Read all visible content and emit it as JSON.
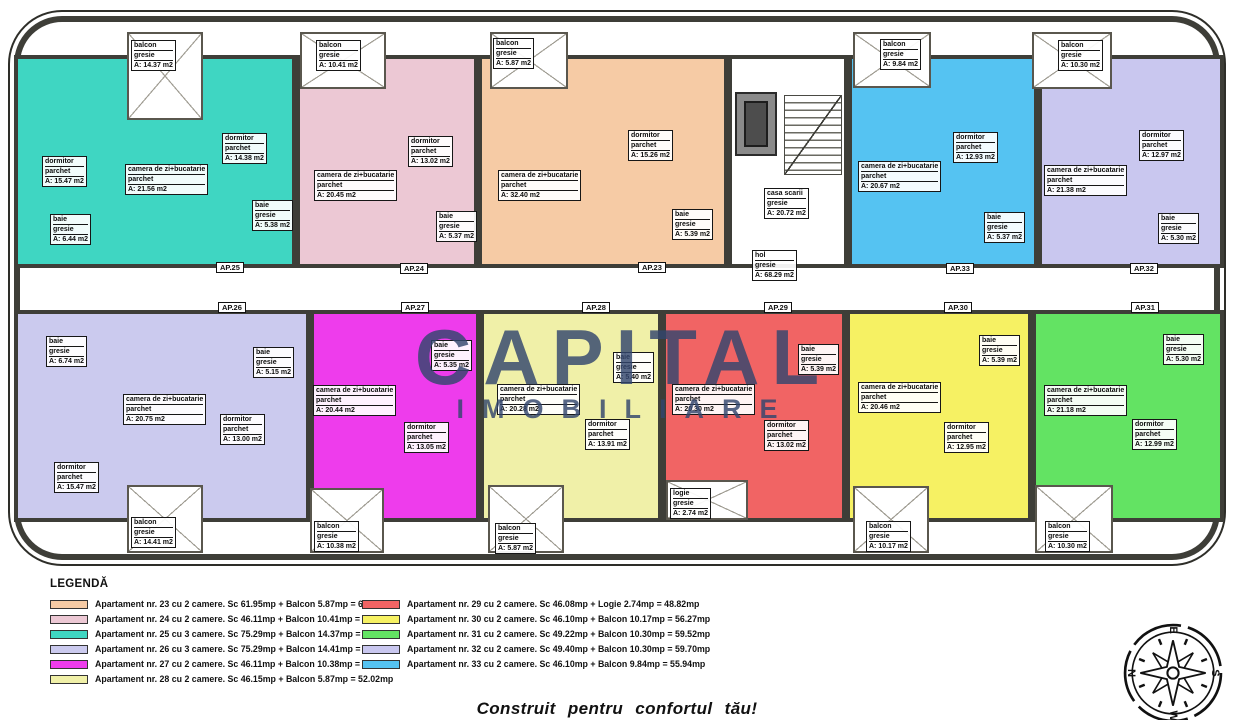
{
  "colors": {
    "ap23": "#f6cba5",
    "ap24": "#ecc8d4",
    "ap25": "#3fd6c2",
    "ap26": "#cbcaee",
    "ap27": "#ee3cec",
    "ap28": "#f0f0a8",
    "ap29": "#f16464",
    "ap30": "#f6f163",
    "ap31": "#63e363",
    "ap32": "#c9c7ef",
    "ap33": "#55c3f2",
    "wall": "#3e3e38",
    "watermark": "#33466e"
  },
  "watermark": {
    "line1": "CAPITAL",
    "line2": "IMOBILIARE"
  },
  "slogan": "Construit pentru confortul tău!",
  "compass": {
    "top": "E",
    "left": "N",
    "right": "S",
    "bottom": "W"
  },
  "core": {
    "casa_scarii": {
      "name": "casa scarii",
      "floor": "gresie",
      "area": "A: 20.72 m2"
    },
    "hol": {
      "name": "hol",
      "floor": "gresie",
      "area": "A: 68.29 m2"
    }
  },
  "apartments": [
    {
      "tag": "AP.25",
      "balcony": {
        "name": "balcon",
        "floor": "gresie",
        "area": "A: 14.37 m2"
      },
      "rooms": [
        {
          "name": "dormitor",
          "floor": "parchet",
          "area": "A: 15.47 m2"
        },
        {
          "name": "camera de zi+bucatarie",
          "floor": "parchet",
          "area": "A: 21.56 m2"
        },
        {
          "name": "dormitor",
          "floor": "parchet",
          "area": "A: 14.38 m2"
        },
        {
          "name": "baie",
          "floor": "gresie",
          "area": "A: 6.44 m2"
        },
        {
          "name": "baie",
          "floor": "gresie",
          "area": "A: 5.38 m2"
        }
      ]
    },
    {
      "tag": "AP.24",
      "balcony": {
        "name": "balcon",
        "floor": "gresie",
        "area": "A: 10.41 m2"
      },
      "rooms": [
        {
          "name": "camera de zi+bucatarie",
          "floor": "parchet",
          "area": "A: 20.45 m2"
        },
        {
          "name": "dormitor",
          "floor": "parchet",
          "area": "A: 13.02 m2"
        },
        {
          "name": "baie",
          "floor": "gresie",
          "area": "A: 5.37 m2"
        }
      ]
    },
    {
      "tag": "AP.23",
      "balcony": {
        "name": "balcon",
        "floor": "gresie",
        "area": "A: 5.87 m2"
      },
      "rooms": [
        {
          "name": "camera de zi+bucatarie",
          "floor": "parchet",
          "area": "A: 32.40 m2"
        },
        {
          "name": "dormitor",
          "floor": "parchet",
          "area": "A: 15.26 m2"
        },
        {
          "name": "baie",
          "floor": "gresie",
          "area": "A: 5.39 m2"
        }
      ]
    },
    {
      "tag": "AP.33",
      "balcony": {
        "name": "balcon",
        "floor": "gresie",
        "area": "A: 9.84 m2"
      },
      "rooms": [
        {
          "name": "camera de zi+bucatarie",
          "floor": "parchet",
          "area": "A: 20.67 m2"
        },
        {
          "name": "dormitor",
          "floor": "parchet",
          "area": "A: 12.93 m2"
        },
        {
          "name": "baie",
          "floor": "gresie",
          "area": "A: 5.37 m2"
        }
      ]
    },
    {
      "tag": "AP.32",
      "balcony": {
        "name": "balcon",
        "floor": "gresie",
        "area": "A: 10.30 m2"
      },
      "rooms": [
        {
          "name": "camera de zi+bucatarie",
          "floor": "parchet",
          "area": "A: 21.38 m2"
        },
        {
          "name": "dormitor",
          "floor": "parchet",
          "area": "A: 12.97 m2"
        },
        {
          "name": "baie",
          "floor": "gresie",
          "area": "A: 5.30 m2"
        }
      ]
    },
    {
      "tag": "AP.26",
      "balcony": {
        "name": "balcon",
        "floor": "gresie",
        "area": "A: 14.41 m2"
      },
      "rooms": [
        {
          "name": "baie",
          "floor": "gresie",
          "area": "A: 6.74 m2"
        },
        {
          "name": "camera de zi+bucatarie",
          "floor": "parchet",
          "area": "A: 20.75 m2"
        },
        {
          "name": "baie",
          "floor": "gresie",
          "area": "A: 5.15 m2"
        },
        {
          "name": "dormitor",
          "floor": "parchet",
          "area": "A: 13.00 m2"
        },
        {
          "name": "dormitor",
          "floor": "parchet",
          "area": "A: 15.47 m2"
        }
      ]
    },
    {
      "tag": "AP.27",
      "balcony": {
        "name": "balcon",
        "floor": "gresie",
        "area": "A: 10.38 m2"
      },
      "rooms": [
        {
          "name": "camera de zi+bucatarie",
          "floor": "parchet",
          "area": "A: 20.44 m2"
        },
        {
          "name": "baie",
          "floor": "gresie",
          "area": "A: 5.35 m2"
        },
        {
          "name": "dormitor",
          "floor": "parchet",
          "area": "A: 13.05 m2"
        }
      ]
    },
    {
      "tag": "AP.28",
      "balcony": {
        "name": "balcon",
        "floor": "gresie",
        "area": "A: 5.87 m2"
      },
      "rooms": [
        {
          "name": "camera de zi+bucatarie",
          "floor": "parchet",
          "area": "A: 20.28 m2"
        },
        {
          "name": "baie",
          "floor": "gresie",
          "area": "A: 5.40 m2"
        },
        {
          "name": "dormitor",
          "floor": "parchet",
          "area": "A: 13.91 m2"
        }
      ]
    },
    {
      "tag": "AP.29",
      "balcony": {
        "name": "logie",
        "floor": "gresie",
        "area": "A: 2.74 m2"
      },
      "rooms": [
        {
          "name": "camera de zi+bucatarie",
          "floor": "parchet",
          "area": "A: 20.30 m2"
        },
        {
          "name": "baie",
          "floor": "gresie",
          "area": "A: 5.39 m2"
        },
        {
          "name": "dormitor",
          "floor": "parchet",
          "area": "A: 13.02 m2"
        }
      ]
    },
    {
      "tag": "AP.30",
      "balcony": {
        "name": "balcon",
        "floor": "gresie",
        "area": "A: 10.17 m2"
      },
      "rooms": [
        {
          "name": "camera de zi+bucatarie",
          "floor": "parchet",
          "area": "A: 20.46 m2"
        },
        {
          "name": "baie",
          "floor": "gresie",
          "area": "A: 5.39 m2"
        },
        {
          "name": "dormitor",
          "floor": "parchet",
          "area": "A: 12.95 m2"
        }
      ]
    },
    {
      "tag": "AP.31",
      "balcony": {
        "name": "balcon",
        "floor": "gresie",
        "area": "A: 10.30 m2"
      },
      "rooms": [
        {
          "name": "camera de zi+bucatarie",
          "floor": "parchet",
          "area": "A: 21.18 m2"
        },
        {
          "name": "baie",
          "floor": "gresie",
          "area": "A: 5.30 m2"
        },
        {
          "name": "dormitor",
          "floor": "parchet",
          "area": "A: 12.99 m2"
        }
      ]
    }
  ],
  "legend": {
    "title": "LEGENDĂ",
    "col1": [
      {
        "text": "Apartament nr. 23 cu 2 camere. Sc 61.95mp + Balcon 5.87mp = 67.82mp"
      },
      {
        "text": "Apartament nr. 24 cu 2 camere. Sc 46.11mp + Balcon 10.41mp = 56.52mp"
      },
      {
        "text": "Apartament nr. 25 cu 3 camere. Sc 75.29mp + Balcon 14.37mp = 89.66mp"
      },
      {
        "text": "Apartament nr. 26 cu 3 camere. Sc 75.29mp + Balcon 14.41mp = 89.7mp"
      },
      {
        "text": "Apartament nr. 27 cu 2 camere. Sc 46.11mp + Balcon 10.38mp = 56.49mp"
      },
      {
        "text": "Apartament nr. 28 cu 2 camere. Sc 46.15mp + Balcon 5.87mp = 52.02mp"
      }
    ],
    "col2": [
      {
        "text": "Apartament nr. 29 cu 2 camere. Sc 46.08mp + Logie 2.74mp = 48.82mp"
      },
      {
        "text": "Apartament nr. 30 cu 2 camere. Sc 46.10mp + Balcon 10.17mp = 56.27mp"
      },
      {
        "text": "Apartament nr. 31 cu 2 camere. Sc 49.22mp + Balcon 10.30mp = 59.52mp"
      },
      {
        "text": "Apartament nr. 32 cu 2 camere. Sc 49.40mp + Balcon 10.30mp = 59.70mp"
      },
      {
        "text": "Apartament nr. 33 cu 2 camere. Sc 46.10mp + Balcon 9.84mp = 55.94mp"
      }
    ]
  }
}
